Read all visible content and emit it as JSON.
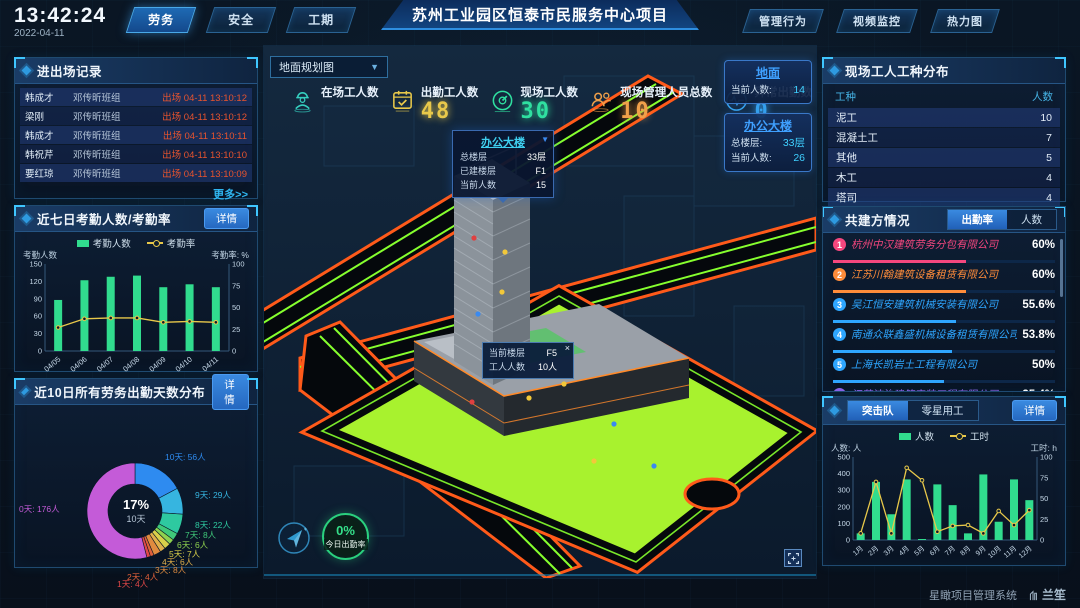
{
  "topbar": {
    "time": "13:42:24",
    "date": "2022-04-11",
    "left_tabs": [
      "劳务",
      "安全",
      "工期"
    ],
    "active_left_tab": "劳务",
    "title": "苏州工业园区恒泰市民服务中心项目",
    "right_tabs": [
      "管理行为",
      "视频监控",
      "热力图"
    ]
  },
  "entry_exit": {
    "title": "进出场记录",
    "more_label": "更多>>",
    "rows": [
      {
        "name": "韩成才",
        "group": "邓传昕班组",
        "event": "出场 04-11 13:10:12"
      },
      {
        "name": "梁刚",
        "group": "邓传昕班组",
        "event": "出场 04-11 13:10:12"
      },
      {
        "name": "韩成才",
        "group": "邓传昕班组",
        "event": "出场 04-11 13:10:11"
      },
      {
        "name": "韩祝芹",
        "group": "邓传昕班组",
        "event": "出场 04-11 13:10:10"
      },
      {
        "name": "要红琼",
        "group": "邓传昕班组",
        "event": "出场 04-11 13:10:09"
      }
    ]
  },
  "attendance_panel": {
    "title": "近七日考勤人数/考勤率",
    "detail_label": "详情"
  },
  "distribution_panel": {
    "title": "近10日所有劳务出勤天数分布",
    "detail_label": "详情"
  },
  "map": {
    "view_select": "地面规划图",
    "stats": [
      {
        "label": "在场工人数",
        "value": "",
        "icon": "worker",
        "color": "#35d0c0"
      },
      {
        "label": "出勤工人数",
        "value": "48",
        "icon": "calendar-check",
        "color": "#e8c84a"
      },
      {
        "label": "现场工人数",
        "value": "30",
        "icon": "gauge",
        "color": "#2fe0a0"
      },
      {
        "label": "现场管理人员总数",
        "value": "10",
        "icon": "people",
        "color": "#f0a04a"
      },
      {
        "label": "异常出勤数",
        "value": "0",
        "icon": "pulse",
        "color": "#38a6f0"
      }
    ],
    "badges": [
      {
        "title": "地面",
        "rows": [
          {
            "label": "当前人数:",
            "value": "14"
          }
        ]
      },
      {
        "title": "办公大楼",
        "rows": [
          {
            "label": "总楼层:",
            "value": "33层"
          },
          {
            "label": "当前人数:",
            "value": "26"
          }
        ]
      }
    ],
    "tooltip_building": {
      "title": "办公大楼",
      "rows": [
        {
          "label": "总楼层",
          "value": "33层"
        },
        {
          "label": "已建楼层",
          "value": "F1"
        },
        {
          "label": "当前人数",
          "value": "15"
        }
      ]
    },
    "tooltip_floor": {
      "close": "×",
      "rows": [
        {
          "label": "当前楼层",
          "value": "F5"
        },
        {
          "label": "工人人数",
          "value": "10人"
        }
      ]
    },
    "attendance_ring": {
      "value": "0%",
      "label": "今日出勤率"
    }
  },
  "worker_types": {
    "title": "现场工人工种分布",
    "columns": [
      "工种",
      "人数"
    ],
    "rows": [
      [
        "泥工",
        "10"
      ],
      [
        "混凝土工",
        "7"
      ],
      [
        "其他",
        "5"
      ],
      [
        "木工",
        "4"
      ],
      [
        "塔司",
        "4"
      ]
    ]
  },
  "partners": {
    "title": "共建方情况",
    "tabs": [
      "出勤率",
      "人数"
    ],
    "active_tab": "出勤率",
    "rows": [
      {
        "rank": "1",
        "name": "杭州中汉建筑劳务分包有限公司",
        "pct": "60%",
        "value": 60,
        "color": "#f5477e"
      },
      {
        "rank": "2",
        "name": "江苏川翰建筑设备租赁有限公司",
        "pct": "60%",
        "value": 60,
        "color": "#ff8c3a"
      },
      {
        "rank": "3",
        "name": "吴江恒安建筑机械安装有限公司",
        "pct": "55.6%",
        "value": 55.6,
        "color": "#2ea6ff"
      },
      {
        "rank": "4",
        "name": "南通众联鑫盛机械设备租赁有限公司",
        "pct": "53.8%",
        "value": 53.8,
        "color": "#2ea6ff"
      },
      {
        "rank": "5",
        "name": "上海长凯岩土工程有限公司",
        "pct": "50%",
        "value": 50,
        "color": "#2ea6ff"
      },
      {
        "rank": "6",
        "name": "江苏洁治建筑安装工程有限公司",
        "pct": "35.4%",
        "value": 35.4,
        "color": "#8a63e8"
      }
    ]
  },
  "squad_panel": {
    "tabs": [
      "突击队",
      "零星用工"
    ],
    "active_tab": "突击队",
    "detail_label": "详情"
  },
  "footer": {
    "system_name": "星瞰项目管理系统",
    "brand": "兰笙"
  },
  "chart_data": [
    {
      "id": "attendance",
      "type": "bar+line",
      "title": "近七日考勤人数/考勤率",
      "categories": [
        "04/05",
        "04/06",
        "04/07",
        "04/08",
        "04/09",
        "04/10",
        "04/11"
      ],
      "series": [
        {
          "name": "考勤人数",
          "type": "bar",
          "axis": "left",
          "values": [
            88,
            122,
            128,
            130,
            110,
            115,
            110
          ],
          "color": "#31dc8e"
        },
        {
          "name": "考勤率",
          "type": "line",
          "axis": "right",
          "values": [
            27,
            37,
            38,
            38,
            33,
            34,
            33
          ],
          "color": "#e8c84a"
        }
      ],
      "left_axis": {
        "label": "考勤人数",
        "min": 0,
        "max": 150,
        "ticks": [
          0,
          30,
          60,
          90,
          120,
          150
        ]
      },
      "right_axis": {
        "label": "考勤率: %",
        "min": 0,
        "max": 100,
        "ticks": [
          0,
          25,
          50,
          75,
          100
        ]
      },
      "legend_position": "top",
      "grid": false
    },
    {
      "id": "days_distribution",
      "type": "pie",
      "title": "近10日所有劳务出勤天数分布",
      "center": {
        "value": "17%",
        "label": "10天"
      },
      "slices": [
        {
          "name": "10天",
          "label": "10天: 56人",
          "value": 56,
          "color": "#2e8bf0"
        },
        {
          "name": "9天",
          "label": "9天: 29人",
          "value": 29,
          "color": "#36b5e0"
        },
        {
          "name": "8天",
          "label": "8天: 22人",
          "value": 22,
          "color": "#2ec9a0"
        },
        {
          "name": "7天",
          "label": "7天: 8人",
          "value": 8,
          "color": "#3fc97a"
        },
        {
          "name": "6天",
          "label": "6天: 6人",
          "value": 6,
          "color": "#8fd24f"
        },
        {
          "name": "5天",
          "label": "5天: 7人",
          "value": 7,
          "color": "#d9d04a"
        },
        {
          "name": "4天",
          "label": "4天: 6人",
          "value": 6,
          "color": "#e0b04a"
        },
        {
          "name": "3天",
          "label": "3天: 8人",
          "value": 8,
          "color": "#e08b3f"
        },
        {
          "name": "2天",
          "label": "2天: 4人",
          "value": 4,
          "color": "#e0603a"
        },
        {
          "name": "1天",
          "label": "1天: 4人",
          "value": 4,
          "color": "#e04848"
        },
        {
          "name": "0天",
          "label": "0天: 176人",
          "value": 176,
          "color": "#c45bd8"
        }
      ]
    },
    {
      "id": "squad",
      "type": "bar+line",
      "title": "突击队",
      "categories": [
        "1月",
        "2月",
        "3月",
        "4月",
        "5月",
        "6月",
        "7月",
        "8月",
        "9月",
        "10月",
        "11月",
        "12月"
      ],
      "series": [
        {
          "name": "人数",
          "type": "bar",
          "axis": "left",
          "values": [
            40,
            350,
            155,
            365,
            5,
            335,
            210,
            40,
            395,
            110,
            365,
            240
          ],
          "color": "#31dc8e"
        },
        {
          "name": "工时",
          "type": "line",
          "axis": "right",
          "values": [
            8,
            70,
            8,
            87,
            72,
            10,
            17,
            18,
            8,
            35,
            18,
            36
          ],
          "color": "#e8c84a"
        }
      ],
      "left_axis": {
        "label": "人数: 人",
        "min": 0,
        "max": 500,
        "ticks": [
          0,
          100,
          200,
          300,
          400,
          500
        ]
      },
      "right_axis": {
        "label": "工时: h",
        "min": 0,
        "max": 100,
        "ticks": [
          0,
          25,
          50,
          75,
          100
        ]
      },
      "legend_position": "top",
      "grid": false
    }
  ]
}
